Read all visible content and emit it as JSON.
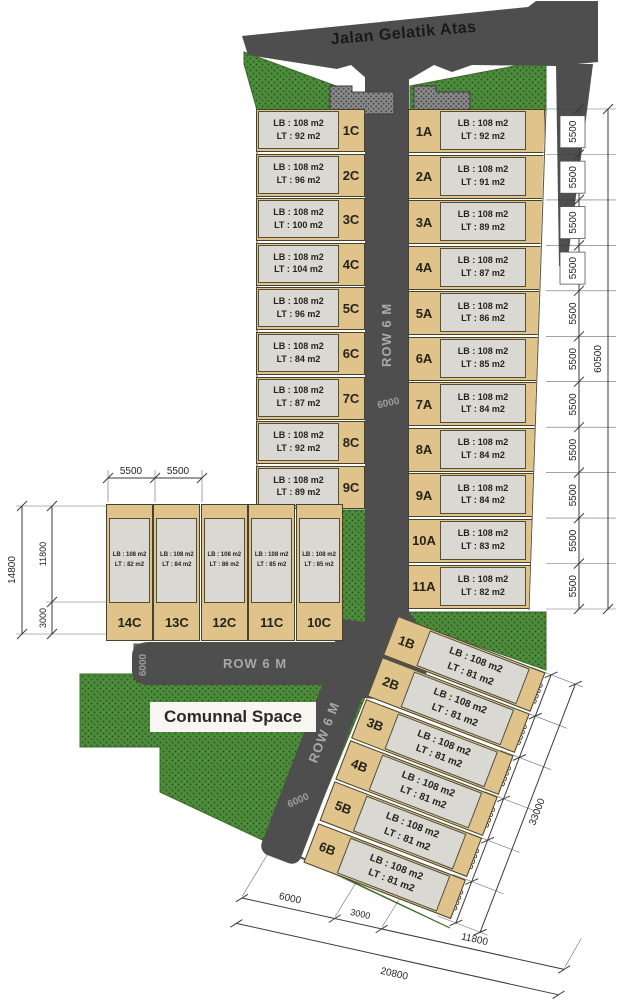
{
  "title_road": "Jalan Gelatik Atas",
  "roads": {
    "row_label": "ROW 6 M",
    "row_width": "6000"
  },
  "communal_label": "Comunnal Space",
  "lb_label": "LB : 108 m2",
  "lots": {
    "c": [
      {
        "label": "1C",
        "lt": "LT : 92 m2"
      },
      {
        "label": "2C",
        "lt": "LT : 96 m2"
      },
      {
        "label": "3C",
        "lt": "LT : 100 m2"
      },
      {
        "label": "4C",
        "lt": "LT : 104 m2"
      },
      {
        "label": "5C",
        "lt": "LT : 96 m2"
      },
      {
        "label": "6C",
        "lt": "LT : 84 m2"
      },
      {
        "label": "7C",
        "lt": "LT : 87 m2"
      },
      {
        "label": "8C",
        "lt": "LT : 92 m2"
      },
      {
        "label": "9C",
        "lt": "LT : 89 m2"
      }
    ],
    "a": [
      {
        "label": "1A",
        "lt": "LT : 92 m2"
      },
      {
        "label": "2A",
        "lt": "LT : 91 m2"
      },
      {
        "label": "3A",
        "lt": "LT : 89 m2"
      },
      {
        "label": "4A",
        "lt": "LT : 87 m2"
      },
      {
        "label": "5A",
        "lt": "LT : 86 m2"
      },
      {
        "label": "6A",
        "lt": "LT : 85 m2"
      },
      {
        "label": "7A",
        "lt": "LT : 84 m2"
      },
      {
        "label": "8A",
        "lt": "LT : 84 m2"
      },
      {
        "label": "9A",
        "lt": "LT : 84 m2"
      },
      {
        "label": "10A",
        "lt": "LT : 83 m2"
      },
      {
        "label": "11A",
        "lt": "LT : 82 m2"
      }
    ],
    "c_back": [
      {
        "label": "14C",
        "lt": "LT : 82 m2"
      },
      {
        "label": "13C",
        "lt": "LT : 84 m2"
      },
      {
        "label": "12C",
        "lt": "LT : 86 m2"
      },
      {
        "label": "11C",
        "lt": "LT : 85 m2"
      },
      {
        "label": "10C",
        "lt": "LT : 85 m2"
      }
    ],
    "b": [
      {
        "label": "1B",
        "lt": "LT : 81 m2"
      },
      {
        "label": "2B",
        "lt": "LT : 81 m2"
      },
      {
        "label": "3B",
        "lt": "LT : 81 m2"
      },
      {
        "label": "4B",
        "lt": "LT : 81 m2"
      },
      {
        "label": "5B",
        "lt": "LT : 81 m2"
      },
      {
        "label": "6B",
        "lt": "LT : 81 m2"
      }
    ]
  },
  "dims": {
    "right": {
      "segments": [
        "5500",
        "5500",
        "5500",
        "5500",
        "5500",
        "5500",
        "5500",
        "5500",
        "5500",
        "5500",
        "5500"
      ],
      "total": "60500"
    },
    "left": {
      "upper": "11800",
      "lower": "3000",
      "total": "14800"
    },
    "back_top": [
      "5500",
      "5500"
    ],
    "b_chain": {
      "segments": [
        "5500",
        "5500",
        "5500",
        "5500",
        "5500",
        "5500"
      ],
      "total": "33000"
    },
    "bottom": {
      "segments": [
        "6000",
        "3000",
        "11800"
      ],
      "total": "20800"
    }
  }
}
